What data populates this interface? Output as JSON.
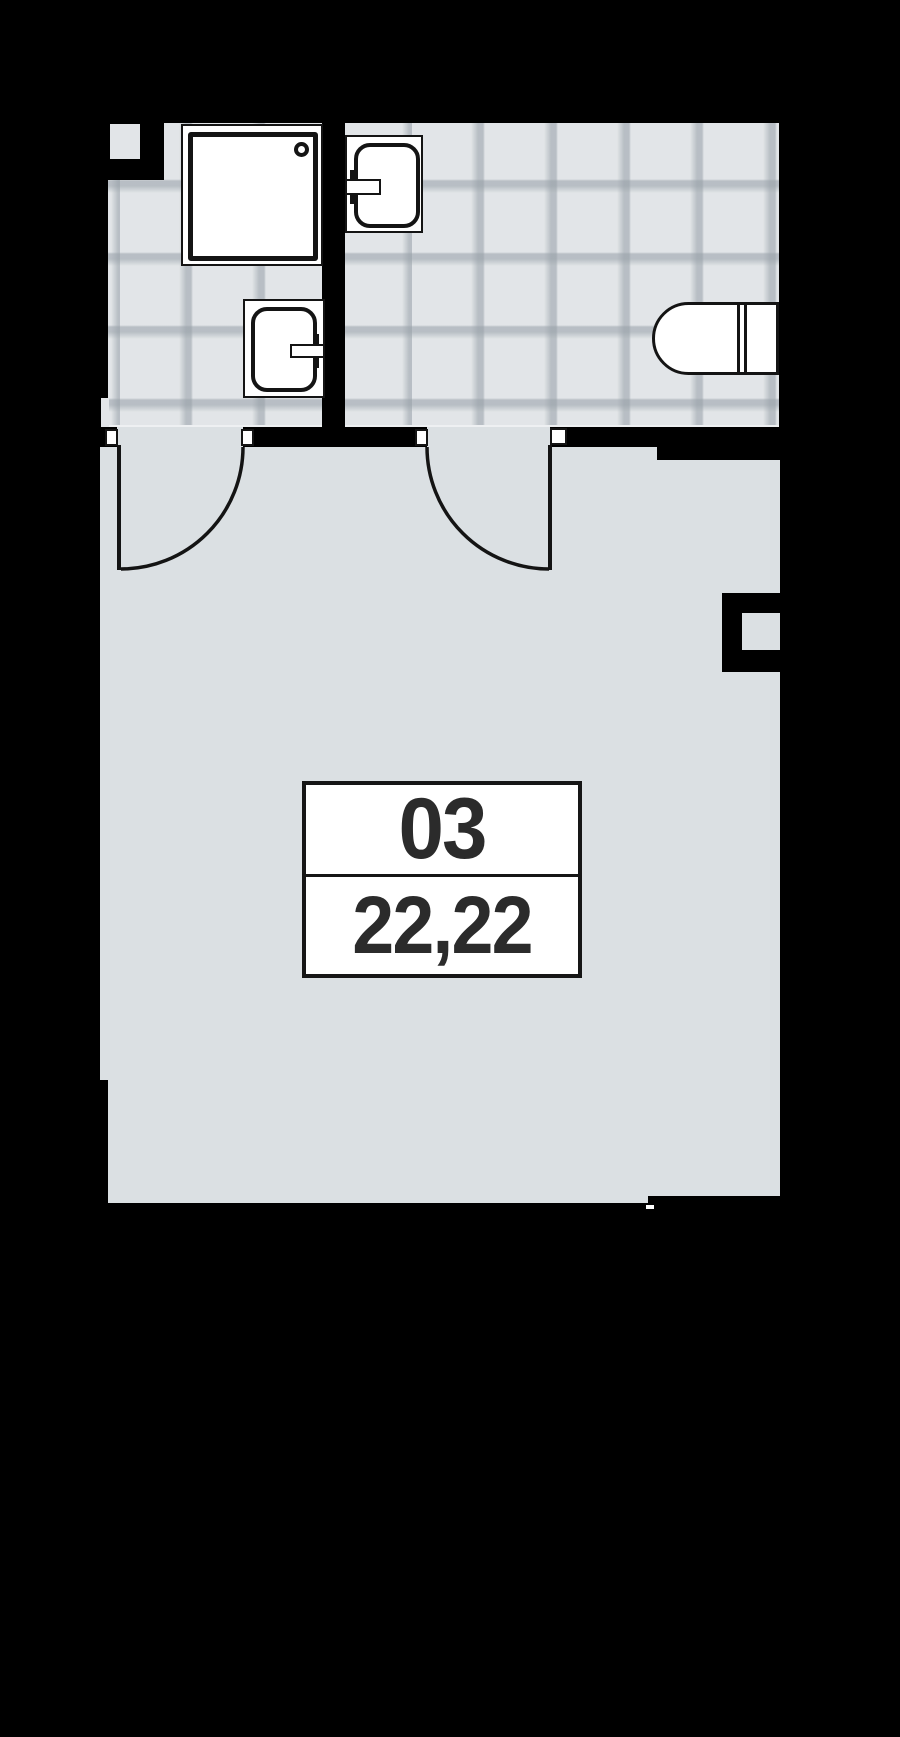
{
  "unit": {
    "number": "03",
    "area": "22,22"
  },
  "colors": {
    "background": "#000000",
    "wall": "#000000",
    "floor_main": "#dbe0e3",
    "floor_tile": "#e2e5e8",
    "tile_grout": "#969fa7",
    "fixture_fill": "#ffffff",
    "outline": "#141414",
    "label_text": "#2b2b2b"
  },
  "rooms": [
    {
      "name": "bathroom-left",
      "flooring": "tile"
    },
    {
      "name": "bathroom-right",
      "flooring": "tile"
    },
    {
      "name": "main-room",
      "flooring": "plain"
    }
  ],
  "fixtures": [
    {
      "name": "shower-tray"
    },
    {
      "name": "wash-basin-top"
    },
    {
      "name": "wash-basin-bottom"
    },
    {
      "name": "water-heater"
    }
  ],
  "doors": [
    {
      "name": "door-left",
      "swing": "quarter-circle"
    },
    {
      "name": "door-right",
      "swing": "quarter-circle"
    }
  ]
}
